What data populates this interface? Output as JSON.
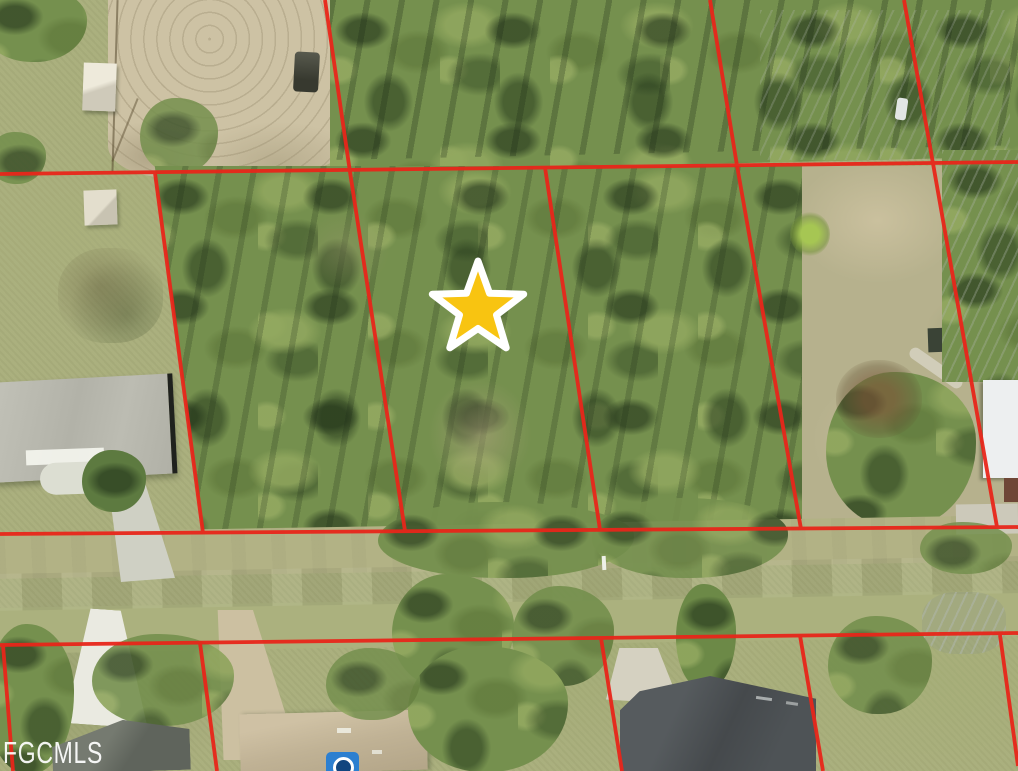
{
  "map": {
    "type": "aerial-parcel-photo",
    "watermark": "FGCMLS",
    "marker": {
      "name": "subject-property-star",
      "fill_color": "#F8C411",
      "stroke_color": "#FFFFFF",
      "stroke_width": 7,
      "points": "478,261 489.5,293.2 523.7,294.2 496.5,315 506.2,347.8 478,328.5 449.8,347.8 459.5,315 432.3,294.2 466.5,293.2"
    },
    "parcel_lines": {
      "color": "#E8261A",
      "width": 3.8,
      "segments": {
        "h_top": "0,174 1018,162",
        "h_mid": "0,534 1018,527",
        "h_bottom": "0,645 1018,633",
        "v1": "325,0 350,172 405,531",
        "v2": "155,173 203,533",
        "v3a": "545,167.5 600,529.8",
        "v3": "710,0 737,165.5 801,529",
        "v4": "904,0 933,163.5 997,527",
        "vb1": "3,645 13,771",
        "vb2": "200,643 217,771",
        "vb3": "601,638 622,771",
        "vb4": "800,635.5 823,771",
        "vb5": "1000,635 1018,766"
      }
    }
  }
}
